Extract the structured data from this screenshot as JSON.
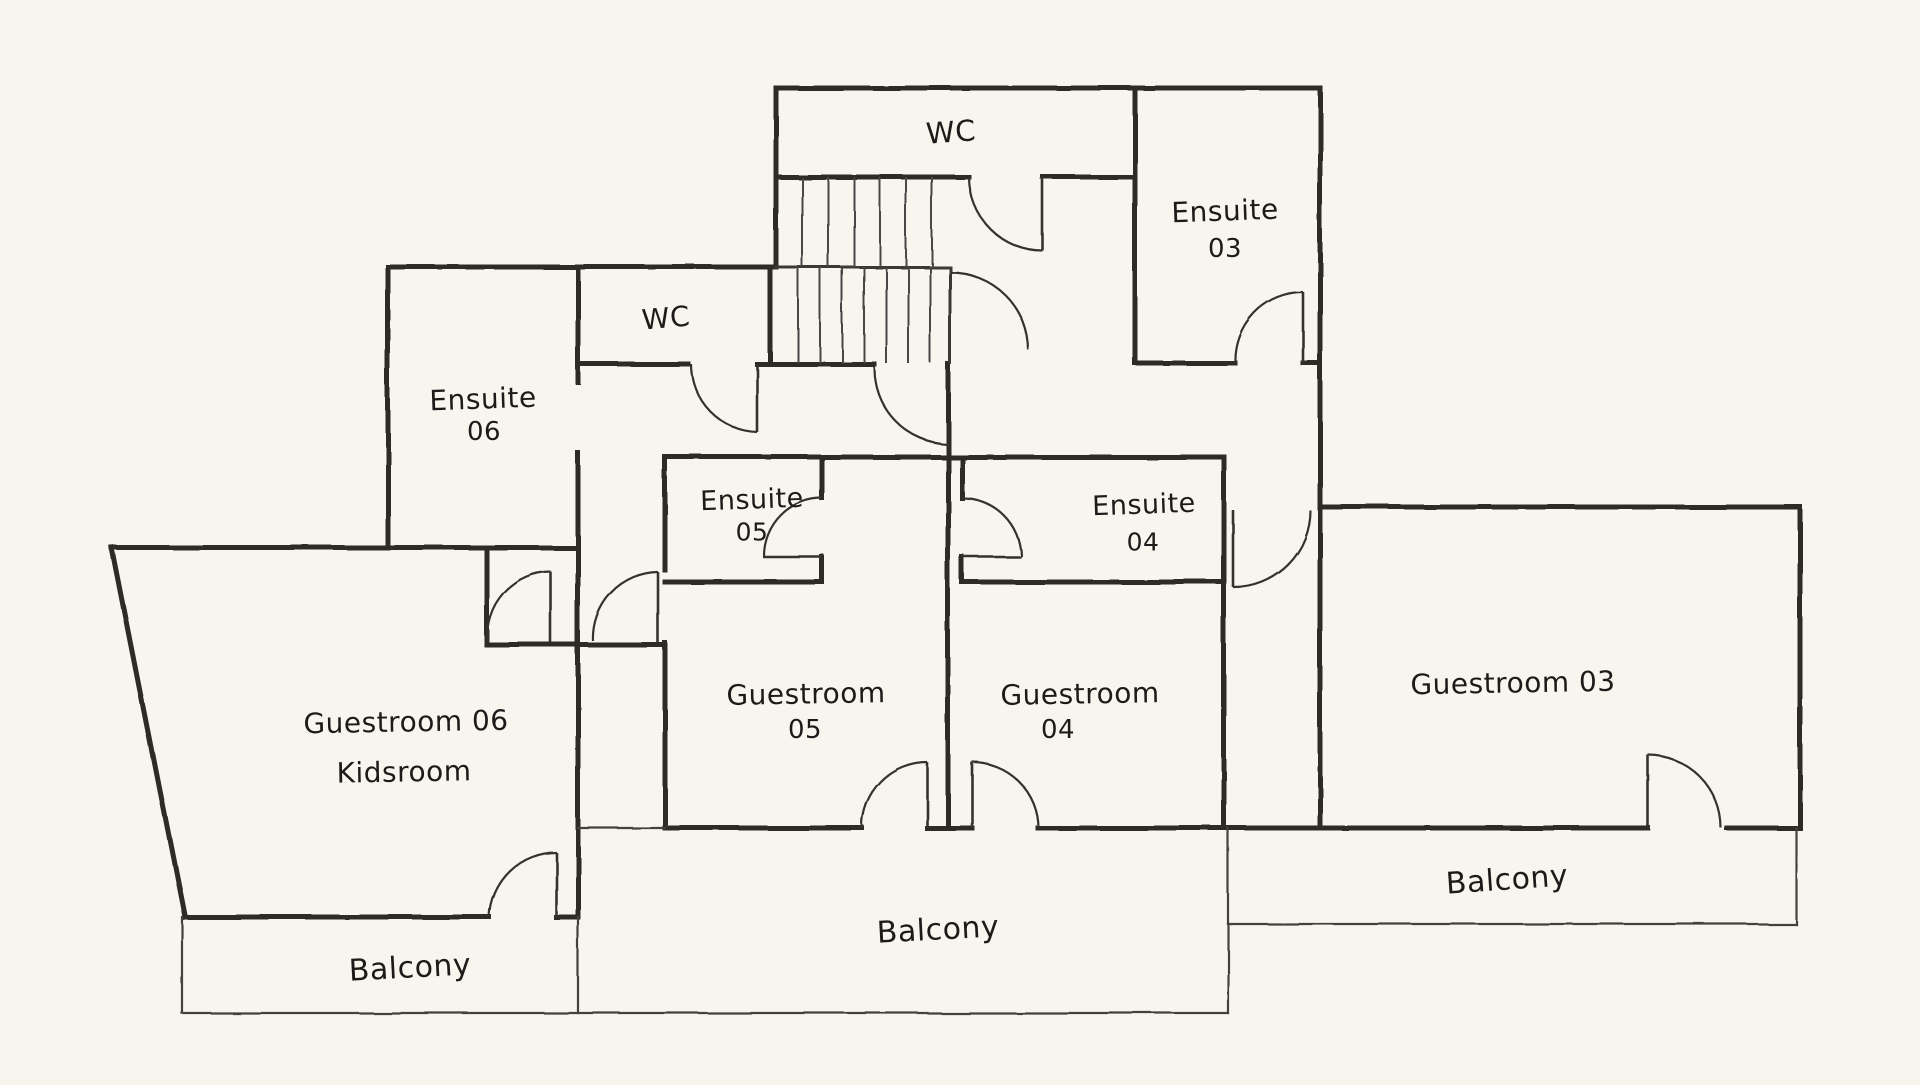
{
  "drawing": {
    "type": "floor-plan",
    "colors": {
      "background": "#f8f5ee",
      "wall_ink": "#2e2b28",
      "thin_ink": "#4a4744",
      "text_ink": "#1d1b19"
    }
  },
  "rooms": [
    {
      "name": "wc-top",
      "lines": [
        {
          "text": "WC",
          "x": 951,
          "y": 132,
          "size": 29,
          "rot": -4
        }
      ]
    },
    {
      "name": "ensuite-03",
      "lines": [
        {
          "text": "Ensuite",
          "x": 1225,
          "y": 211,
          "size": 28,
          "rot": -2
        },
        {
          "text": "03",
          "x": 1225,
          "y": 249,
          "size": 26,
          "rot": 0
        }
      ]
    },
    {
      "name": "wc-small",
      "lines": [
        {
          "text": "WC",
          "x": 666,
          "y": 318,
          "size": 28,
          "rot": -5
        }
      ]
    },
    {
      "name": "ensuite-06",
      "lines": [
        {
          "text": "Ensuite",
          "x": 483,
          "y": 399,
          "size": 28,
          "rot": -2
        },
        {
          "text": "06",
          "x": 484,
          "y": 432,
          "size": 26,
          "rot": 0
        }
      ]
    },
    {
      "name": "ensuite-05",
      "lines": [
        {
          "text": "Ensuite",
          "x": 752,
          "y": 500,
          "size": 27,
          "rot": -2
        },
        {
          "text": "05",
          "x": 752,
          "y": 532,
          "size": 25,
          "rot": 0
        }
      ]
    },
    {
      "name": "ensuite-04",
      "lines": [
        {
          "text": "Ensuite",
          "x": 1144,
          "y": 505,
          "size": 27,
          "rot": -2
        },
        {
          "text": "04",
          "x": 1143,
          "y": 542,
          "size": 25,
          "rot": 0
        }
      ]
    },
    {
      "name": "guestroom-06",
      "lines": [
        {
          "text": "Guestroom 06",
          "x": 406,
          "y": 722,
          "size": 28,
          "rot": -1
        },
        {
          "text": "Kidsroom",
          "x": 404,
          "y": 772,
          "size": 28,
          "rot": -1
        }
      ]
    },
    {
      "name": "guestroom-05",
      "lines": [
        {
          "text": "Guestroom",
          "x": 806,
          "y": 694,
          "size": 28,
          "rot": -1
        },
        {
          "text": "05",
          "x": 805,
          "y": 730,
          "size": 26,
          "rot": 0
        }
      ]
    },
    {
      "name": "guestroom-04",
      "lines": [
        {
          "text": "Guestroom",
          "x": 1080,
          "y": 694,
          "size": 28,
          "rot": -1
        },
        {
          "text": "04",
          "x": 1058,
          "y": 730,
          "size": 26,
          "rot": 0
        }
      ]
    },
    {
      "name": "guestroom-03",
      "lines": [
        {
          "text": "Guestroom 03",
          "x": 1513,
          "y": 683,
          "size": 28,
          "rot": -1
        }
      ]
    },
    {
      "name": "balcony-left",
      "lines": [
        {
          "text": "Balcony",
          "x": 410,
          "y": 968,
          "size": 30,
          "rot": -3
        }
      ]
    },
    {
      "name": "balcony-center",
      "lines": [
        {
          "text": "Balcony",
          "x": 938,
          "y": 930,
          "size": 30,
          "rot": -3
        }
      ]
    },
    {
      "name": "balcony-right",
      "lines": [
        {
          "text": "Balcony",
          "x": 1507,
          "y": 880,
          "size": 30,
          "rot": -4
        }
      ]
    }
  ]
}
